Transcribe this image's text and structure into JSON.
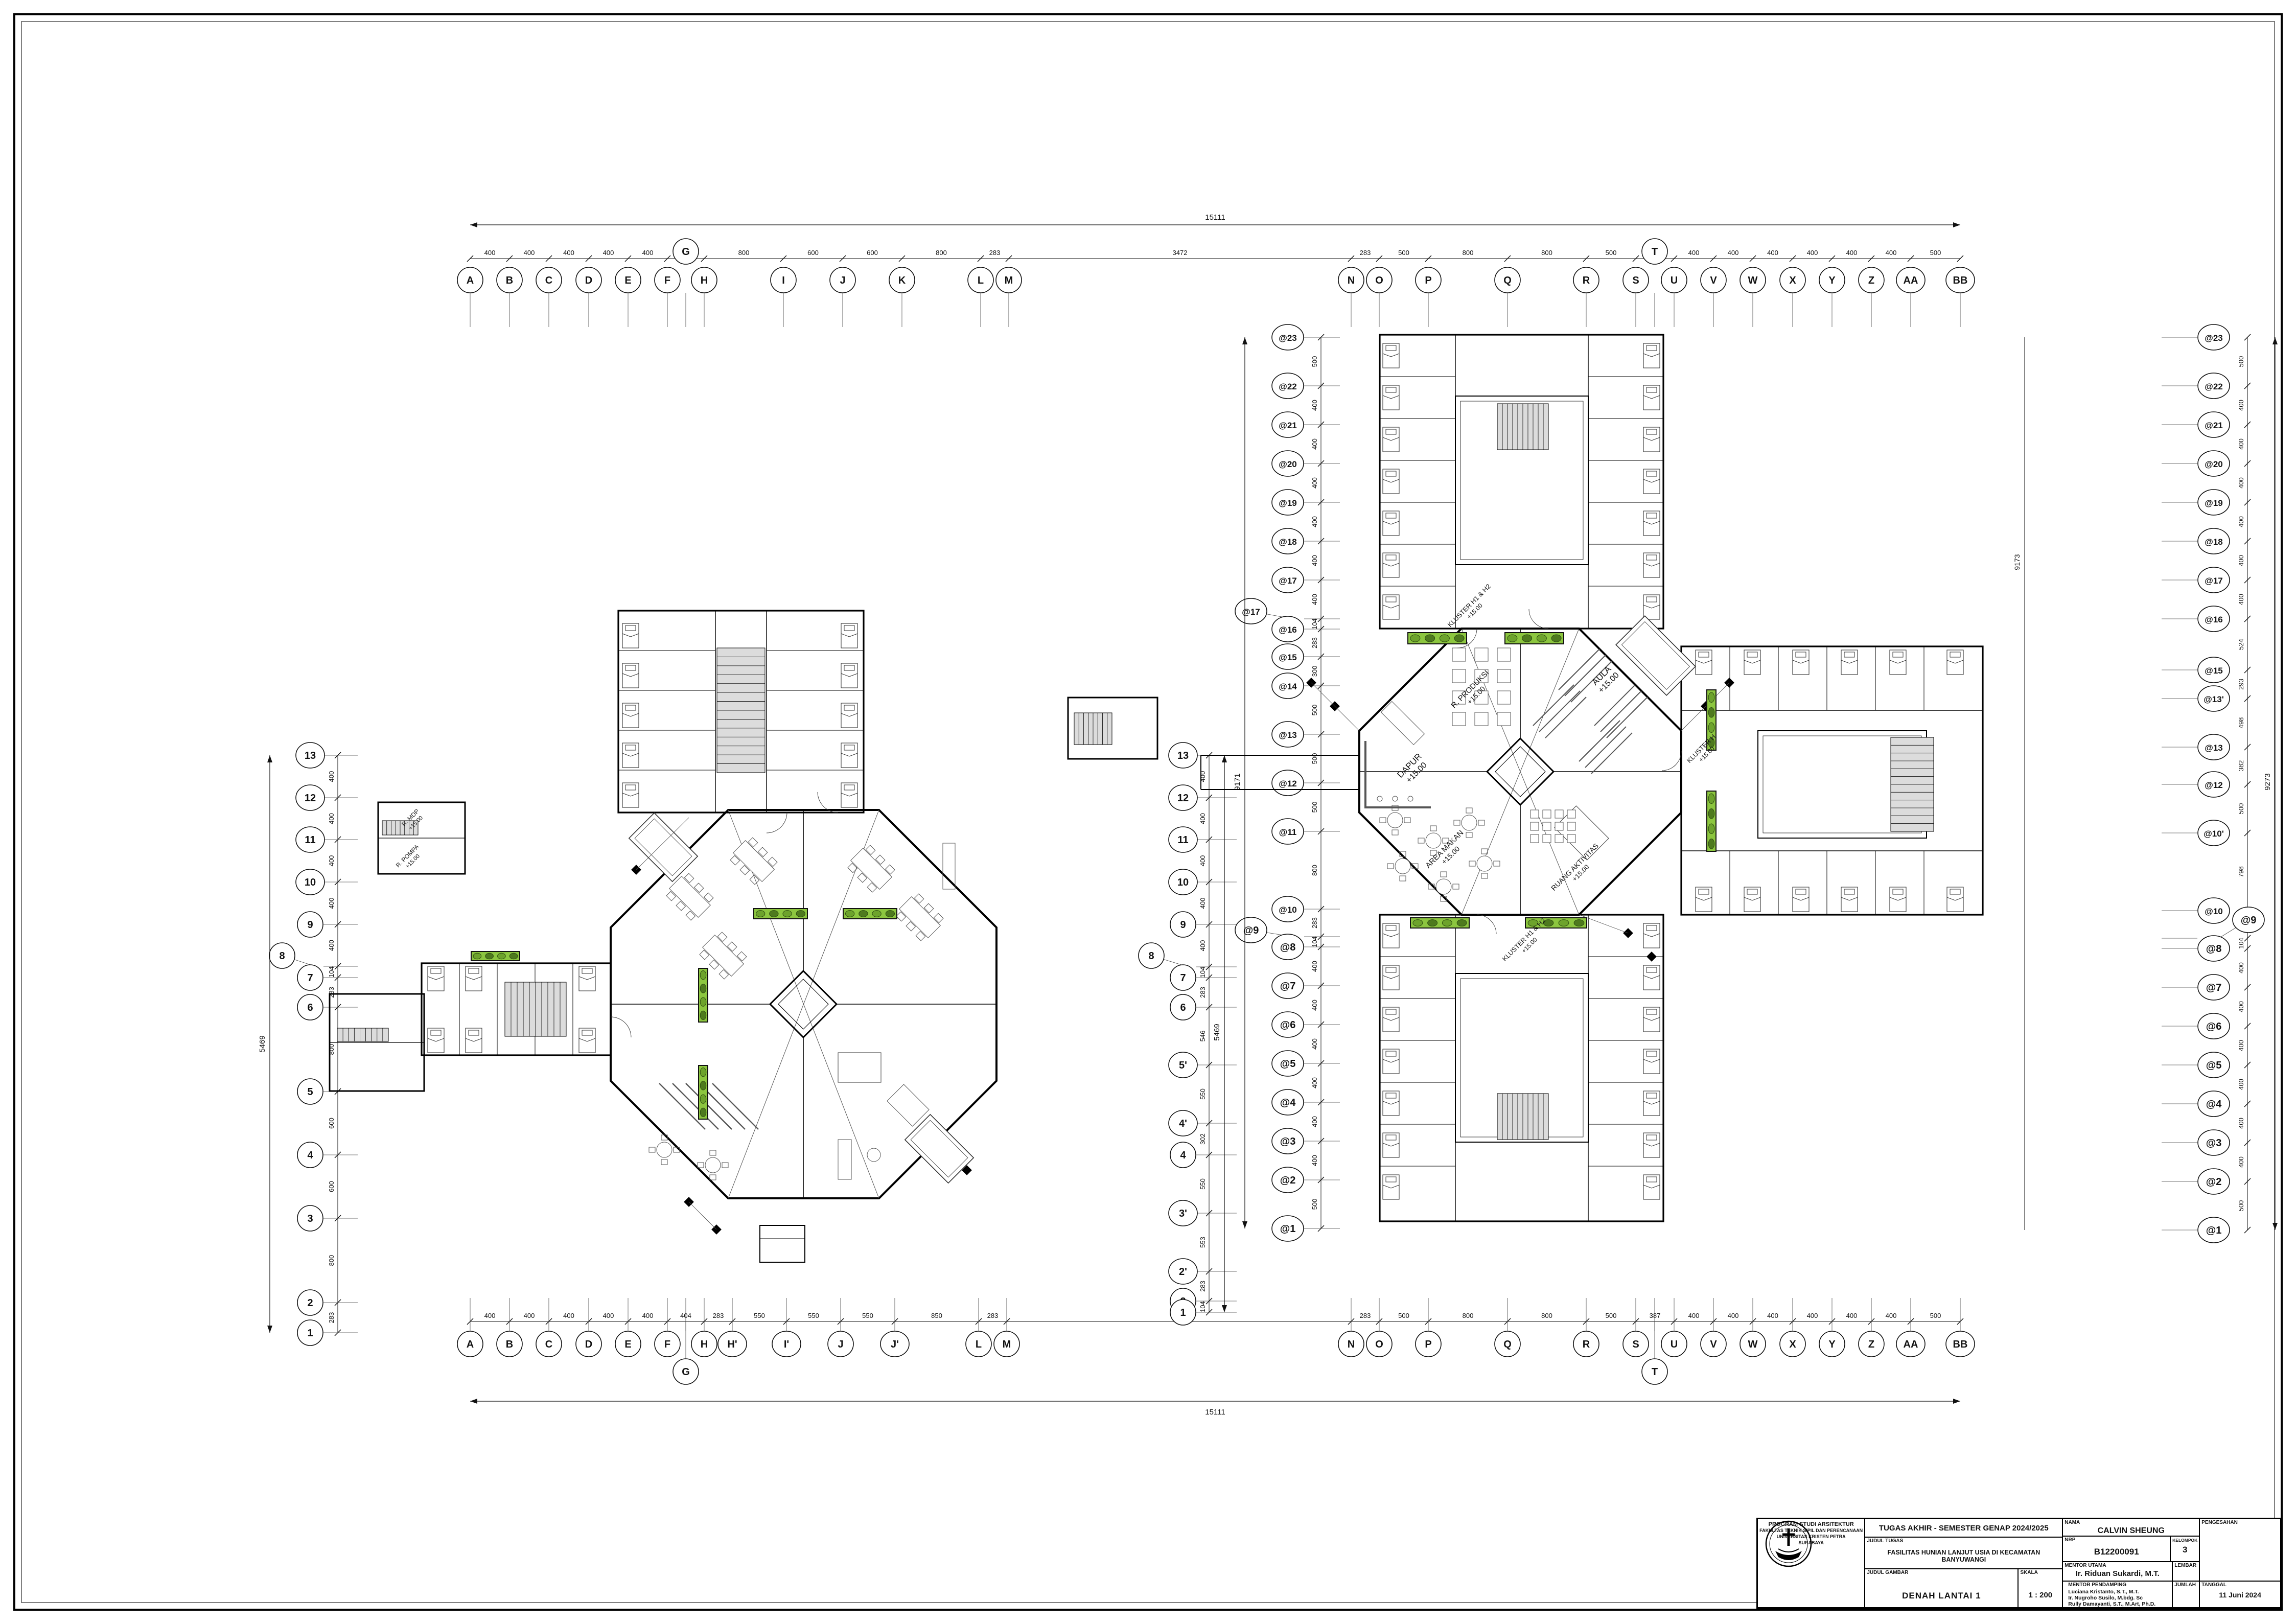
{
  "sheet": {
    "project_header": "TUGAS AKHIR - SEMESTER GENAP 2024/2025",
    "labels": {
      "judul_tugas": "JUDUL TUGAS",
      "judul_gambar": "JUDUL GAMBAR",
      "skala": "SKALA",
      "nama": "NAMA",
      "nrp": "NRP",
      "kelompok": "KELOMPOK",
      "mentor_utama": "MENTOR UTAMA",
      "mentor_pendamping": "MENTOR PENDAMPING",
      "lembar": "LEMBAR",
      "jumlah": "JUMLAH",
      "pengesahan": "PENGESAHAN",
      "tanggal": "TANGGAL"
    },
    "judul_tugas": "FASILITAS HUNIAN LANJUT USIA DI KECAMATAN BANYUWANGI",
    "judul_gambar": "DENAH LANTAI 1",
    "skala": "1 : 200",
    "nama": "CALVIN SHEUNG",
    "nrp": "B12200091",
    "kelompok": "3",
    "mentor_utama": "Ir. Riduan Sukardi, M.T.",
    "mentor_pendamping": [
      "Luciana Kristanto, S.T., M.T.",
      "Ir. Nugroho Susilo, M.bdg. Sc",
      "Rully Damayanti, S.T., M.Art, Ph.D."
    ],
    "tanggal": "11 Juni 2024",
    "institution": [
      "PROGRAM STUDI ARSITEKTUR",
      "FAKULTAS TEKNIK SIPIL DAN PERENCANAAN",
      "UNIVERSITAS KRISTEN PETRA",
      "SURABAYA"
    ]
  },
  "grids": {
    "top": {
      "overall": "15111",
      "letters": [
        "A",
        "B",
        "C",
        "D",
        "E",
        "F",
        "G",
        "H",
        "I",
        "J",
        "K",
        "L",
        "M",
        "N",
        "O",
        "P",
        "Q",
        "R",
        "S",
        "T",
        "U",
        "V",
        "W",
        "X",
        "Y",
        "Z",
        "AA",
        "BB"
      ],
      "dims": [
        "400",
        "400",
        "400",
        "400",
        "400",
        "373",
        "800",
        "600",
        "600",
        "800",
        "283",
        "3472",
        "283",
        "500",
        "800",
        "800",
        "500",
        "387",
        "400",
        "400",
        "400",
        "400",
        "400",
        "400",
        "500"
      ]
    },
    "bottom": {
      "overall": "15111",
      "letters": [
        "A",
        "B",
        "C",
        "D",
        "E",
        "F",
        "G",
        "H",
        "H'",
        "I'",
        "J",
        "J'",
        "L",
        "M",
        "N",
        "O",
        "P",
        "Q",
        "R",
        "S",
        "T",
        "U",
        "V",
        "W",
        "X",
        "Y",
        "Z",
        "AA",
        "BB"
      ],
      "dims": [
        "400",
        "400",
        "400",
        "400",
        "400",
        "404",
        "283",
        "550",
        "550",
        "550",
        "850",
        "283",
        "3472",
        "283",
        "500",
        "800",
        "800",
        "500",
        "387",
        "400",
        "400",
        "400",
        "400",
        "400",
        "400",
        "500"
      ]
    },
    "left_col": {
      "overall": "5469",
      "labels": [
        "13",
        "12",
        "11",
        "10",
        "9",
        "8",
        "7",
        "6",
        "5",
        "4",
        "3",
        "2",
        "1"
      ],
      "dims": [
        "400",
        "400",
        "400",
        "400",
        "400",
        "104",
        "283",
        "800",
        "600",
        "600",
        "800",
        "283"
      ]
    },
    "mid_col": {
      "overall": "5469",
      "labels": [
        "13",
        "12",
        "11",
        "10",
        "9",
        "8",
        "7",
        "6",
        "5'",
        "4'",
        "4",
        "3'",
        "2'",
        "2",
        "1"
      ],
      "dims": [
        "400",
        "400",
        "400",
        "400",
        "400",
        "104",
        "283",
        "546",
        "550",
        "302",
        "550",
        "553",
        "283",
        "104"
      ]
    },
    "at_left_col": {
      "overall": "9171",
      "labels": [
        "@23",
        "@22",
        "@21",
        "@20",
        "@19",
        "@18",
        "@17",
        "@17",
        "@16",
        "@15",
        "@14",
        "@13",
        "@12",
        "@11",
        "@10",
        "@9",
        "@8",
        "@7",
        "@6",
        "@5",
        "@4",
        "@3",
        "@2",
        "@1"
      ],
      "dims": [
        "500",
        "400",
        "400",
        "400",
        "400",
        "400",
        "400",
        "104",
        "283",
        "300",
        "500",
        "500",
        "500",
        "800",
        "283",
        "104",
        "400",
        "400",
        "400",
        "400",
        "400",
        "400",
        "500"
      ]
    },
    "at_right_col": {
      "overall": "9273",
      "overall_inner": "9173",
      "labels": [
        "@23",
        "@22",
        "@21",
        "@20",
        "@19",
        "@18",
        "@17",
        "@16",
        "@15",
        "@13'",
        "@13",
        "@12",
        "@10'",
        "@10",
        "@9",
        "@8",
        "@7",
        "@6",
        "@5",
        "@4",
        "@3",
        "@2",
        "@1"
      ],
      "dims": [
        "500",
        "400",
        "400",
        "400",
        "400",
        "400",
        "400",
        "524",
        "293",
        "498",
        "382",
        "500",
        "798",
        "283",
        "104",
        "400",
        "400",
        "400",
        "400",
        "400",
        "400",
        "500"
      ]
    }
  },
  "rooms": [
    {
      "id": "dapur",
      "label": "DAPUR",
      "level": "+15.00"
    },
    {
      "id": "produksi",
      "label": "R. PRODUKSI",
      "level": "+15.00"
    },
    {
      "id": "aula",
      "label": "AULA",
      "level": "+15.00"
    },
    {
      "id": "area_makan",
      "label": "AREA MAKAN",
      "level": "+15.00"
    },
    {
      "id": "aktivitas",
      "label": "RUANG AKTIVITAS",
      "level": "+15.00"
    },
    {
      "id": "mdp",
      "label": "R. MDP",
      "level": "+15.00"
    },
    {
      "id": "pompa",
      "label": "R. POMPA",
      "level": "+15.00"
    },
    {
      "id": "kluster_nw",
      "label": "KLUSTER H1 & H2",
      "level": "+15.00"
    },
    {
      "id": "kluster_sw",
      "label": "KLUSTER H1 & H2",
      "level": "+15.00"
    },
    {
      "id": "kluster_e",
      "label": "KLUSTER H",
      "level": "+15.00"
    }
  ]
}
